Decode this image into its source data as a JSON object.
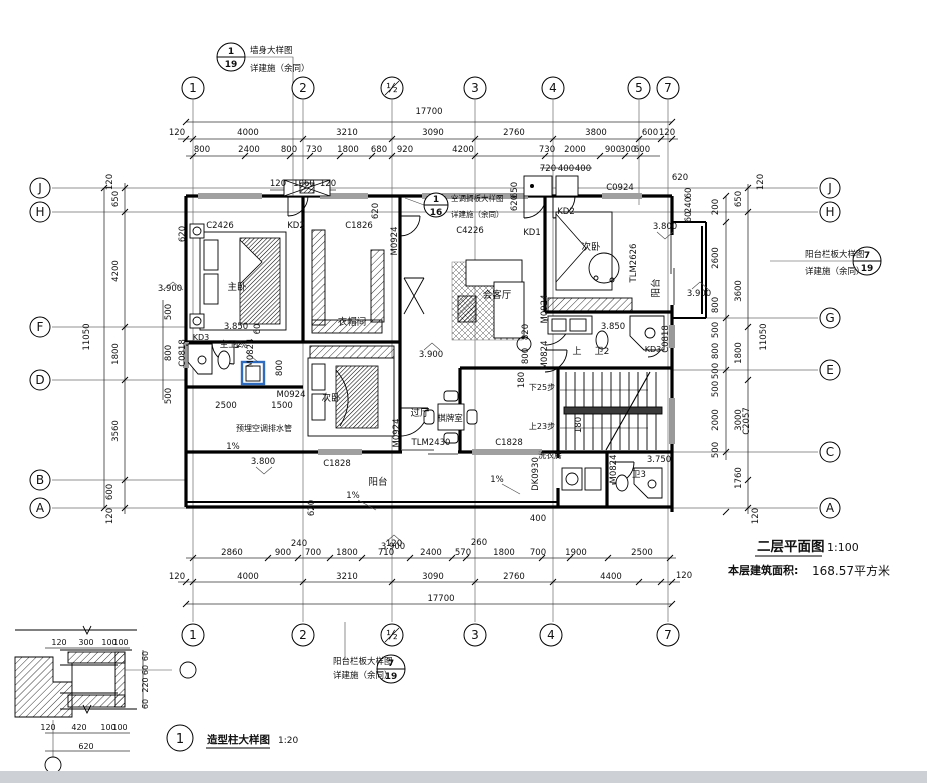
{
  "title_block": {
    "plan_name": "二层平面图",
    "plan_scale": "1:100",
    "area_label": "本层建筑面积:",
    "area_value": "168.57平方米"
  },
  "detail_block": {
    "title": "造型柱大样图",
    "scale": "1:20",
    "bubble": "1"
  },
  "grid": {
    "top_bubbles": [
      {
        "t": "1",
        "x": 193,
        "y": 88
      },
      {
        "t": "2",
        "x": 303,
        "y": 88
      },
      {
        "t": "½",
        "x": 392,
        "y": 88
      },
      {
        "t": "3",
        "x": 475,
        "y": 88
      },
      {
        "t": "4",
        "x": 553,
        "y": 88
      },
      {
        "t": "5",
        "x": 639,
        "y": 88
      },
      {
        "t": "7",
        "x": 668,
        "y": 88
      }
    ],
    "bottom_bubbles": [
      {
        "t": "1",
        "x": 193,
        "y": 635
      },
      {
        "t": "2",
        "x": 303,
        "y": 635
      },
      {
        "t": "½",
        "x": 392,
        "y": 635
      },
      {
        "t": "3",
        "x": 475,
        "y": 635
      },
      {
        "t": "4",
        "x": 551,
        "y": 635
      },
      {
        "t": "7",
        "x": 668,
        "y": 635
      }
    ],
    "left_bubbles": [
      {
        "t": "J",
        "x": 40,
        "y": 188
      },
      {
        "t": "H",
        "x": 40,
        "y": 212
      },
      {
        "t": "F",
        "x": 40,
        "y": 327
      },
      {
        "t": "D",
        "x": 40,
        "y": 380
      },
      {
        "t": "B",
        "x": 40,
        "y": 480
      },
      {
        "t": "A",
        "x": 40,
        "y": 508
      }
    ],
    "right_bubbles": [
      {
        "t": "J",
        "x": 830,
        "y": 188
      },
      {
        "t": "H",
        "x": 830,
        "y": 212
      },
      {
        "t": "G",
        "x": 830,
        "y": 318
      },
      {
        "t": "E",
        "x": 830,
        "y": 370
      },
      {
        "t": "C",
        "x": 830,
        "y": 452
      },
      {
        "t": "A",
        "x": 830,
        "y": 508
      }
    ]
  },
  "callouts": [
    {
      "n": "wall-detail-callout",
      "num": "1",
      "den": "19",
      "cx": 231,
      "cy": 57,
      "r": 14
    },
    {
      "n": "ac-shelf-detail-callout",
      "num": "1",
      "den": "16",
      "cx": 436,
      "cy": 205,
      "r": 12
    },
    {
      "n": "balcony-rail-detail-callout-right",
      "num": "7",
      "den": "19",
      "cx": 867,
      "cy": 261,
      "r": 14
    },
    {
      "n": "balcony-rail-detail-callout-bottom",
      "num": "7",
      "den": "19",
      "cx": 391,
      "cy": 669,
      "r": 14
    },
    {
      "n": "column-detail-callout",
      "num": "1",
      "cx": 180,
      "cy": 738,
      "r": 13
    }
  ],
  "labels": [
    {
      "n": "callout-text",
      "t": "墙身大样图",
      "x": 250,
      "y": 53,
      "s": 8.5,
      "a": "s"
    },
    {
      "n": "callout-text",
      "t": "详建施（余同）",
      "x": 250,
      "y": 71,
      "s": 8.5,
      "a": "s"
    },
    {
      "n": "callout-text",
      "t": "空调搁板大样图",
      "x": 451,
      "y": 201,
      "s": 7.5,
      "a": "s"
    },
    {
      "n": "callout-text",
      "t": "详建施（余同）",
      "x": 451,
      "y": 217,
      "s": 7.5,
      "a": "s"
    },
    {
      "n": "callout-text",
      "t": "阳台栏板大样图",
      "x": 805,
      "y": 257,
      "s": 8.5,
      "a": "s"
    },
    {
      "n": "callout-text",
      "t": "详建施（余同）",
      "x": 805,
      "y": 274,
      "s": 8.5,
      "a": "s"
    },
    {
      "n": "callout-text",
      "t": "阳台栏板大样图",
      "x": 333,
      "y": 664,
      "s": 8.5,
      "a": "s"
    },
    {
      "n": "callout-text",
      "t": "详建施（余同）",
      "x": 333,
      "y": 678,
      "s": 8.5,
      "a": "s"
    },
    {
      "n": "dim",
      "t": "17700",
      "x": 429,
      "y": 114
    },
    {
      "n": "dim",
      "t": "120",
      "x": 177,
      "y": 135
    },
    {
      "n": "dim",
      "t": "4000",
      "x": 248,
      "y": 135
    },
    {
      "n": "dim",
      "t": "3210",
      "x": 347,
      "y": 135
    },
    {
      "n": "dim",
      "t": "3090",
      "x": 433,
      "y": 135
    },
    {
      "n": "dim",
      "t": "2760",
      "x": 514,
      "y": 135
    },
    {
      "n": "dim",
      "t": "3800",
      "x": 596,
      "y": 135
    },
    {
      "n": "dim",
      "t": "600",
      "x": 650,
      "y": 135
    },
    {
      "n": "dim",
      "t": "120",
      "x": 667,
      "y": 135
    },
    {
      "n": "dim",
      "t": "800",
      "x": 202,
      "y": 152
    },
    {
      "n": "dim",
      "t": "2400",
      "x": 249,
      "y": 152
    },
    {
      "n": "dim",
      "t": "800",
      "x": 289,
      "y": 152
    },
    {
      "n": "dim",
      "t": "730",
      "x": 314,
      "y": 152
    },
    {
      "n": "dim",
      "t": "1800",
      "x": 348,
      "y": 152
    },
    {
      "n": "dim",
      "t": "680",
      "x": 379,
      "y": 152
    },
    {
      "n": "dim",
      "t": "920",
      "x": 405,
      "y": 152
    },
    {
      "n": "dim",
      "t": "4200",
      "x": 463,
      "y": 152
    },
    {
      "n": "dim",
      "t": "730",
      "x": 547,
      "y": 152
    },
    {
      "n": "dim",
      "t": "2000",
      "x": 575,
      "y": 152
    },
    {
      "n": "dim",
      "t": "900",
      "x": 613,
      "y": 152
    },
    {
      "n": "dim",
      "t": "300",
      "x": 628,
      "y": 152
    },
    {
      "n": "dim",
      "t": "600",
      "x": 642,
      "y": 152
    },
    {
      "n": "dim",
      "t": "720",
      "x": 548,
      "y": 171
    },
    {
      "n": "dim",
      "t": "400",
      "x": 566,
      "y": 171
    },
    {
      "n": "dim",
      "t": "400",
      "x": 583,
      "y": 171
    },
    {
      "n": "dim",
      "t": "120",
      "x": 278,
      "y": 186
    },
    {
      "n": "dim",
      "t": "1060",
      "x": 304,
      "y": 186
    },
    {
      "n": "dim",
      "t": "120",
      "x": 328,
      "y": 186
    },
    {
      "n": "dim",
      "t": "620",
      "x": 680,
      "y": 180
    },
    {
      "n": "dim",
      "t": "650",
      "x": 517,
      "y": 190,
      "r": 1
    },
    {
      "n": "dim",
      "t": "620",
      "x": 517,
      "y": 203,
      "r": 1
    },
    {
      "n": "dim",
      "t": "620",
      "x": 378,
      "y": 211,
      "r": 1
    },
    {
      "n": "dim",
      "t": "620",
      "x": 185,
      "y": 234,
      "r": 1
    },
    {
      "n": "dim",
      "t": "60",
      "x": 691,
      "y": 193,
      "r": 1
    },
    {
      "n": "dim",
      "t": "240",
      "x": 691,
      "y": 205,
      "r": 1
    },
    {
      "n": "dim",
      "t": "60",
      "x": 691,
      "y": 217,
      "r": 1
    },
    {
      "n": "dim",
      "t": "120",
      "x": 112,
      "y": 182,
      "r": 1
    },
    {
      "n": "dim",
      "t": "650",
      "x": 118,
      "y": 199,
      "r": 1
    },
    {
      "n": "dim",
      "t": "4200",
      "x": 118,
      "y": 271,
      "r": 1
    },
    {
      "n": "dim",
      "t": "1800",
      "x": 118,
      "y": 354,
      "r": 1
    },
    {
      "n": "dim",
      "t": "3560",
      "x": 118,
      "y": 431,
      "r": 1
    },
    {
      "n": "dim",
      "t": "600",
      "x": 112,
      "y": 492,
      "r": 1
    },
    {
      "n": "dim",
      "t": "120",
      "x": 112,
      "y": 516,
      "r": 1
    },
    {
      "n": "dim",
      "t": "11050",
      "x": 89,
      "y": 337,
      "r": 1
    },
    {
      "n": "dim",
      "t": "500",
      "x": 171,
      "y": 312,
      "r": 1
    },
    {
      "n": "dim",
      "t": "800",
      "x": 171,
      "y": 353,
      "r": 1
    },
    {
      "n": "dim",
      "t": "500",
      "x": 171,
      "y": 396,
      "r": 1
    },
    {
      "n": "dim",
      "t": "120",
      "x": 763,
      "y": 182,
      "r": 1
    },
    {
      "n": "dim",
      "t": "650",
      "x": 741,
      "y": 199,
      "r": 1
    },
    {
      "n": "dim",
      "t": "3600",
      "x": 741,
      "y": 291,
      "r": 1
    },
    {
      "n": "dim",
      "t": "1800",
      "x": 741,
      "y": 353,
      "r": 1
    },
    {
      "n": "dim",
      "t": "3000",
      "x": 741,
      "y": 420,
      "r": 1
    },
    {
      "n": "dim",
      "t": "1760",
      "x": 741,
      "y": 478,
      "r": 1
    },
    {
      "n": "dim",
      "t": "120",
      "x": 758,
      "y": 516,
      "r": 1
    },
    {
      "n": "dim",
      "t": "11050",
      "x": 766,
      "y": 337,
      "r": 1
    },
    {
      "n": "dim",
      "t": "200",
      "x": 718,
      "y": 207,
      "r": 1
    },
    {
      "n": "dim",
      "t": "2600",
      "x": 718,
      "y": 258,
      "r": 1
    },
    {
      "n": "dim",
      "t": "800",
      "x": 718,
      "y": 305,
      "r": 1
    },
    {
      "n": "dim",
      "t": "500",
      "x": 718,
      "y": 330,
      "r": 1
    },
    {
      "n": "dim",
      "t": "800",
      "x": 718,
      "y": 351,
      "r": 1
    },
    {
      "n": "dim",
      "t": "500",
      "x": 718,
      "y": 371,
      "r": 1
    },
    {
      "n": "dim",
      "t": "500",
      "x": 718,
      "y": 389,
      "r": 1
    },
    {
      "n": "dim",
      "t": "2000",
      "x": 718,
      "y": 420,
      "r": 1
    },
    {
      "n": "dim",
      "t": "500",
      "x": 718,
      "y": 450,
      "r": 1
    },
    {
      "n": "dim",
      "t": "C2057",
      "x": 749,
      "y": 421,
      "r": 1
    },
    {
      "n": "dim",
      "t": "240",
      "x": 299,
      "y": 546
    },
    {
      "n": "dim",
      "t": "120",
      "x": 394,
      "y": 546
    },
    {
      "n": "dim",
      "t": "260",
      "x": 479,
      "y": 545
    },
    {
      "n": "dim",
      "t": "2860",
      "x": 232,
      "y": 555
    },
    {
      "n": "dim",
      "t": "900",
      "x": 283,
      "y": 555
    },
    {
      "n": "dim",
      "t": "700",
      "x": 313,
      "y": 555
    },
    {
      "n": "dim",
      "t": "1800",
      "x": 347,
      "y": 555
    },
    {
      "n": "dim",
      "t": "710",
      "x": 386,
      "y": 555
    },
    {
      "n": "dim",
      "t": "2400",
      "x": 431,
      "y": 555
    },
    {
      "n": "dim",
      "t": "570",
      "x": 463,
      "y": 555
    },
    {
      "n": "dim",
      "t": "1800",
      "x": 504,
      "y": 555
    },
    {
      "n": "dim",
      "t": "700",
      "x": 538,
      "y": 555
    },
    {
      "n": "dim",
      "t": "1900",
      "x": 576,
      "y": 555
    },
    {
      "n": "dim",
      "t": "2500",
      "x": 642,
      "y": 555
    },
    {
      "n": "dim",
      "t": "120",
      "x": 177,
      "y": 579
    },
    {
      "n": "dim",
      "t": "4000",
      "x": 248,
      "y": 579
    },
    {
      "n": "dim",
      "t": "3210",
      "x": 347,
      "y": 579
    },
    {
      "n": "dim",
      "t": "3090",
      "x": 433,
      "y": 579
    },
    {
      "n": "dim",
      "t": "2760",
      "x": 514,
      "y": 579
    },
    {
      "n": "dim",
      "t": "4400",
      "x": 611,
      "y": 579
    },
    {
      "n": "dim",
      "t": "120",
      "x": 684,
      "y": 578
    },
    {
      "n": "dim",
      "t": "17700",
      "x": 441,
      "y": 601
    },
    {
      "n": "dim",
      "t": "400",
      "x": 538,
      "y": 521
    },
    {
      "n": "dim",
      "t": "620",
      "x": 314,
      "y": 508,
      "r": 1
    },
    {
      "n": "level",
      "t": "3.900",
      "x": 170,
      "y": 291
    },
    {
      "n": "level",
      "t": "3.850",
      "x": 236,
      "y": 329
    },
    {
      "n": "dim",
      "t": "60",
      "x": 260,
      "y": 329,
      "r": 1
    },
    {
      "n": "level",
      "t": "3.800",
      "x": 263,
      "y": 464
    },
    {
      "n": "level",
      "t": "3.900",
      "x": 431,
      "y": 357
    },
    {
      "n": "level",
      "t": "3.900",
      "x": 699,
      "y": 296
    },
    {
      "n": "level",
      "t": "3.800",
      "x": 665,
      "y": 229
    },
    {
      "n": "level",
      "t": "3.850",
      "x": 613,
      "y": 329
    },
    {
      "n": "level",
      "t": "3.750",
      "x": 659,
      "y": 462
    },
    {
      "n": "level",
      "t": "3.900",
      "x": 393,
      "y": 549
    },
    {
      "n": "slope",
      "t": "1%",
      "x": 241,
      "y": 348
    },
    {
      "n": "slope",
      "t": "1%",
      "x": 233,
      "y": 449
    },
    {
      "n": "slope",
      "t": "1%",
      "x": 353,
      "y": 498
    },
    {
      "n": "slope",
      "t": "1%",
      "x": 497,
      "y": 482
    },
    {
      "n": "note",
      "t": "预埋空调排水管",
      "x": 264,
      "y": 431,
      "s": 8
    },
    {
      "n": "dim",
      "t": "800",
      "x": 282,
      "y": 368,
      "r": 1
    },
    {
      "n": "dim",
      "t": "820",
      "x": 528,
      "y": 332,
      "r": 1
    },
    {
      "n": "dim",
      "t": "800",
      "x": 528,
      "y": 356,
      "r": 1
    },
    {
      "n": "dim",
      "t": "180",
      "x": 524,
      "y": 380,
      "r": 1
    },
    {
      "n": "dim",
      "t": "180",
      "x": 581,
      "y": 425,
      "r": 1
    },
    {
      "n": "dim",
      "t": "2500",
      "x": 226,
      "y": 408
    },
    {
      "n": "dim",
      "t": "1500",
      "x": 282,
      "y": 408
    },
    {
      "n": "opening",
      "t": "M0924",
      "x": 291,
      "y": 397
    },
    {
      "n": "room",
      "t": "主卧",
      "x": 237,
      "y": 290,
      "s": 9.5
    },
    {
      "n": "room",
      "t": "衣帽间",
      "x": 352,
      "y": 325,
      "s": 9.5
    },
    {
      "n": "room",
      "t": "会客厅",
      "x": 497,
      "y": 298,
      "s": 9.5
    },
    {
      "n": "room",
      "t": "次卧",
      "x": 591,
      "y": 250,
      "s": 9.5
    },
    {
      "n": "room",
      "t": "阳台",
      "x": 659,
      "y": 288,
      "r": 1,
      "s": 9.5
    },
    {
      "n": "room",
      "t": "主卫2",
      "x": 231,
      "y": 347,
      "s": 8.5
    },
    {
      "n": "room",
      "t": "卫2",
      "x": 602,
      "y": 354,
      "s": 9
    },
    {
      "n": "room",
      "t": "上",
      "x": 577,
      "y": 354,
      "s": 9
    },
    {
      "n": "room",
      "t": "过厅",
      "x": 420,
      "y": 416,
      "s": 9.5
    },
    {
      "n": "room",
      "t": "棋牌室",
      "x": 450,
      "y": 421,
      "s": 8.5
    },
    {
      "n": "room",
      "t": "次卧",
      "x": 331,
      "y": 401,
      "s": 9.5
    },
    {
      "n": "room",
      "t": "阳台",
      "x": 378,
      "y": 485,
      "s": 9.5
    },
    {
      "n": "room",
      "t": "洗衣房",
      "x": 550,
      "y": 458,
      "s": 8
    },
    {
      "n": "room",
      "t": "卫3",
      "x": 639,
      "y": 477,
      "s": 8.5
    },
    {
      "n": "stair-note",
      "t": "下25步",
      "x": 542,
      "y": 390,
      "s": 8
    },
    {
      "n": "stair-note",
      "t": "上23步",
      "x": 542,
      "y": 429,
      "s": 8
    },
    {
      "n": "opening",
      "t": "C2426",
      "x": 220,
      "y": 228
    },
    {
      "n": "opening",
      "t": "KD2",
      "x": 296,
      "y": 228
    },
    {
      "n": "opening",
      "t": "C1826",
      "x": 359,
      "y": 228
    },
    {
      "n": "opening",
      "t": "C4226",
      "x": 470,
      "y": 233
    },
    {
      "n": "opening",
      "t": "KD1",
      "x": 532,
      "y": 235
    },
    {
      "n": "opening",
      "t": "KD2",
      "x": 566,
      "y": 214
    },
    {
      "n": "opening",
      "t": "C0924",
      "x": 620,
      "y": 190
    },
    {
      "n": "opening",
      "t": "M0924",
      "x": 397,
      "y": 241,
      "r": 1
    },
    {
      "n": "opening",
      "t": "TLM2626",
      "x": 636,
      "y": 263,
      "r": 1
    },
    {
      "n": "opening",
      "t": "M0924",
      "x": 547,
      "y": 309,
      "r": 1
    },
    {
      "n": "opening",
      "t": "M0824",
      "x": 547,
      "y": 355,
      "r": 1
    },
    {
      "n": "opening",
      "t": "KD3",
      "x": 653,
      "y": 352,
      "s": 8
    },
    {
      "n": "opening",
      "t": "C0818",
      "x": 668,
      "y": 339,
      "r": 1
    },
    {
      "n": "opening",
      "t": "KD3",
      "x": 201,
      "y": 340,
      "s": 8
    },
    {
      "n": "opening",
      "t": "C0818",
      "x": 185,
      "y": 353,
      "r": 1
    },
    {
      "n": "opening",
      "t": "M0824",
      "x": 253,
      "y": 353,
      "r": 1
    },
    {
      "n": "opening",
      "t": "M0924",
      "x": 399,
      "y": 433,
      "r": 1
    },
    {
      "n": "opening",
      "t": "TLM2430",
      "x": 431,
      "y": 445
    },
    {
      "n": "opening",
      "t": "C1828",
      "x": 509,
      "y": 445
    },
    {
      "n": "opening",
      "t": "C1828",
      "x": 337,
      "y": 466
    },
    {
      "n": "opening",
      "t": "DK0930",
      "x": 538,
      "y": 474,
      "r": 1
    },
    {
      "n": "opening",
      "t": "M0824",
      "x": 616,
      "y": 469,
      "r": 1
    },
    {
      "n": "detail-dim",
      "t": "120",
      "x": 59,
      "y": 645,
      "s": 8
    },
    {
      "n": "detail-dim",
      "t": "300",
      "x": 86,
      "y": 645,
      "s": 8
    },
    {
      "n": "detail-dim",
      "t": "100",
      "x": 109,
      "y": 645,
      "s": 8
    },
    {
      "n": "detail-dim",
      "t": "100",
      "x": 121,
      "y": 645,
      "s": 8
    },
    {
      "n": "detail-dim",
      "t": "60",
      "x": 148,
      "y": 656,
      "r": 1,
      "s": 8
    },
    {
      "n": "detail-dim",
      "t": "60",
      "x": 148,
      "y": 670,
      "r": 1,
      "s": 8
    },
    {
      "n": "detail-dim",
      "t": "220",
      "x": 148,
      "y": 685,
      "r": 1,
      "s": 8
    },
    {
      "n": "detail-dim",
      "t": "60",
      "x": 148,
      "y": 704,
      "r": 1,
      "s": 8
    },
    {
      "n": "detail-dim",
      "t": "120",
      "x": 48,
      "y": 730,
      "s": 8
    },
    {
      "n": "detail-dim",
      "t": "420",
      "x": 79,
      "y": 730,
      "s": 8
    },
    {
      "n": "detail-dim",
      "t": "100",
      "x": 108,
      "y": 730,
      "s": 8
    },
    {
      "n": "detail-dim",
      "t": "100",
      "x": 120,
      "y": 730,
      "s": 8
    },
    {
      "n": "detail-dim",
      "t": "620",
      "x": 86,
      "y": 749,
      "s": 8
    }
  ]
}
